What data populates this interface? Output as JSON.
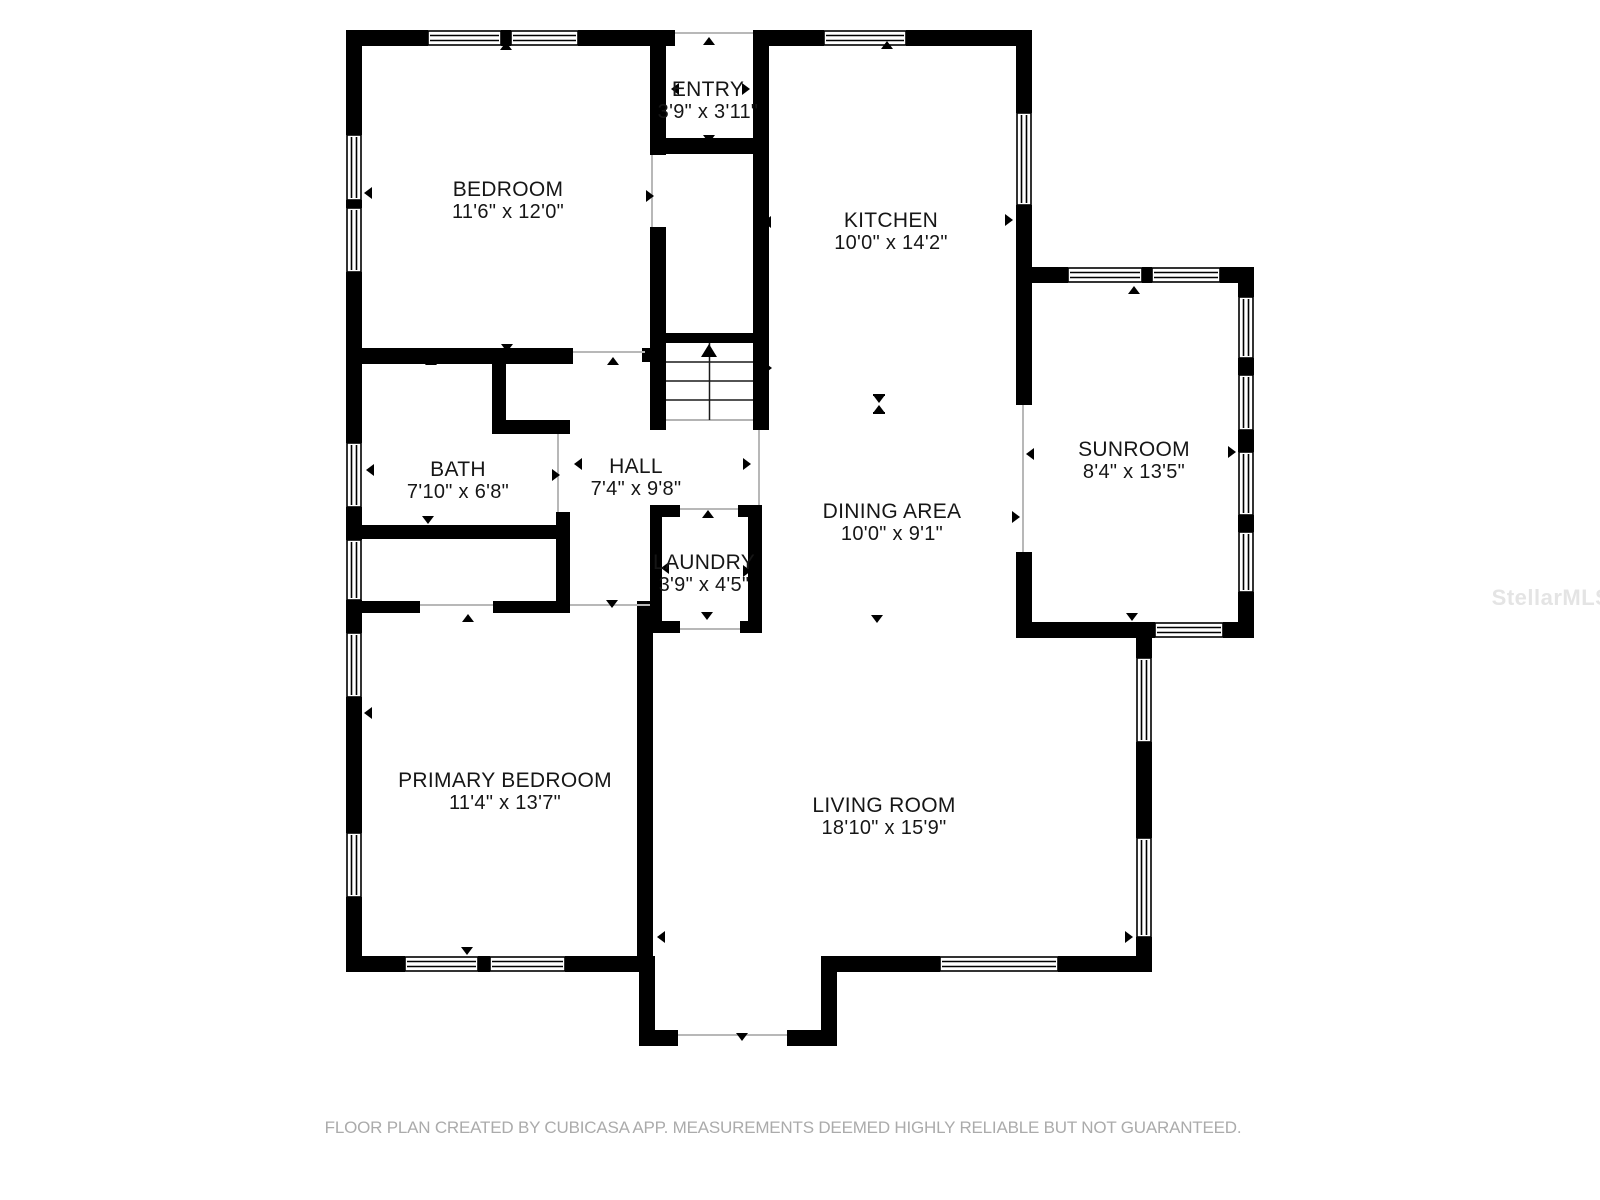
{
  "rooms": [
    {
      "name": "BEDROOM",
      "dims": "11'6\" x 12'0\""
    },
    {
      "name": "ENTRY",
      "dims": "3'9\" x 3'11\""
    },
    {
      "name": "KITCHEN",
      "dims": "10'0\" x 14'2\""
    },
    {
      "name": "SUNROOM",
      "dims": "8'4\" x 13'5\""
    },
    {
      "name": "BATH",
      "dims": "7'10\" x 6'8\""
    },
    {
      "name": "HALL",
      "dims": "7'4\" x 9'8\""
    },
    {
      "name": "LAUNDRY",
      "dims": "3'9\" x 4'5\""
    },
    {
      "name": "DINING AREA",
      "dims": "10'0\" x 9'1\""
    },
    {
      "name": "PRIMARY BEDROOM",
      "dims": "11'4\" x 13'7\""
    },
    {
      "name": "LIVING ROOM",
      "dims": "18'10\" x 15'9\""
    }
  ],
  "footer": {
    "text": "FLOOR PLAN CREATED BY CUBICASA APP. MEASUREMENTS DEEMED HIGHLY RELIABLE BUT NOT GUARANTEED."
  },
  "watermark": {
    "text": "StellarMLS"
  },
  "colors": {
    "wall": "#000000",
    "opening_line": "#b8b8b8",
    "label_text": "#161616",
    "footer_text": "#ababab",
    "watermark_text": "#e4e4e4"
  }
}
